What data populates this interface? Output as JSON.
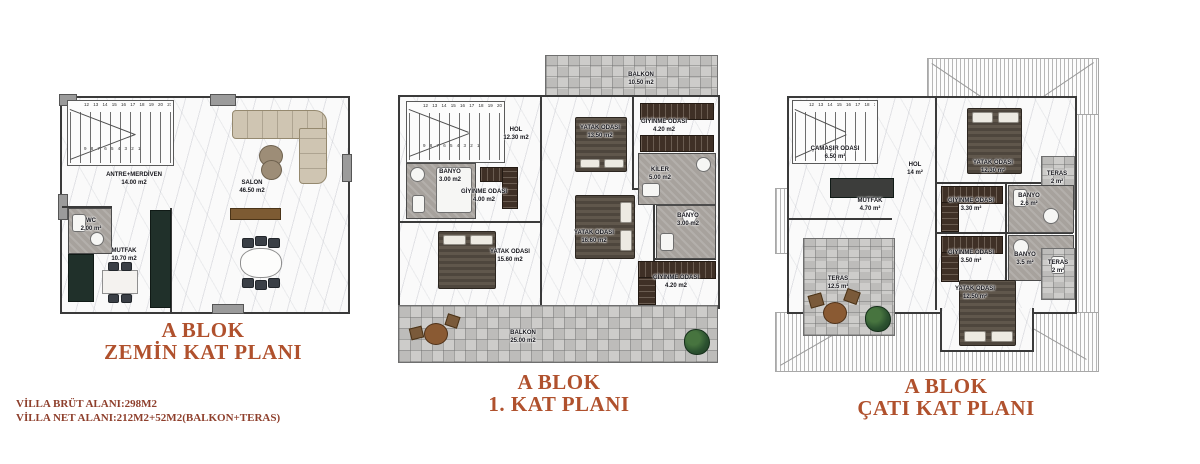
{
  "plans": [
    {
      "id": "zemin-kat",
      "title_line1": "A BLOK",
      "title_line2": "ZEMİN KAT PLANI",
      "stair_numbers_top": "12 13 14 15 16 17 18 19 20 21 22 23 24",
      "stair_numbers_run": "9 8 7 6 5 4 3 2 1",
      "rooms": {
        "antre": {
          "name": "ANTRE+MERDİVEN",
          "area": "14.00 m2"
        },
        "salon": {
          "name": "SALON",
          "area": "46.50 m2"
        },
        "wc": {
          "name": "WC",
          "area": "2.00 m²"
        },
        "mutfak": {
          "name": "MUTFAK",
          "area": "10.70 m2"
        }
      }
    },
    {
      "id": "kat-1",
      "title_line1": "A BLOK",
      "title_line2": "1. KAT PLANI",
      "stair_numbers_top": "12 13 14 15 16 17 18 19 20 21 22 23 24",
      "stair_numbers_run": "9 8 7 6 5 4 3 2 1",
      "rooms": {
        "balkon_ust": {
          "name": "BALKON",
          "area": "10.50 m2"
        },
        "hol": {
          "name": "HOL",
          "area": "12.30 m2"
        },
        "banyo_sol": {
          "name": "BANYO",
          "area": "3.00 m2"
        },
        "giyinme_sol": {
          "name": "GİYİNME ODASI",
          "area": "4.00 m2"
        },
        "yatak_ust": {
          "name": "YATAK ODASI",
          "area": "13.50 m2"
        },
        "giyinme_ustsag": {
          "name": "GİYİNME ODASI",
          "area": "4.20 m2"
        },
        "kiler": {
          "name": "KİLER",
          "area": "5.00 m2"
        },
        "banyo_sag": {
          "name": "BANYO",
          "area": "3.00 m2"
        },
        "yatak_sol": {
          "name": "YATAK ODASI",
          "area": "15.60 m2"
        },
        "yatak_orta": {
          "name": "YATAK ODASI",
          "area": "16.60 m2"
        },
        "giyinme_altsag": {
          "name": "GİYİNME ODASI",
          "area": "4.20 m2"
        },
        "balkon_alt": {
          "name": "BALKON",
          "area": "25.00 m2"
        }
      }
    },
    {
      "id": "cati-kat",
      "title_line1": "A BLOK",
      "title_line2": "ÇATI KAT PLANI",
      "stair_numbers_top": "12 13 14 15 16 17 18 19 20",
      "rooms": {
        "camasir": {
          "name": "ÇAMAŞIR ODASI",
          "area": "6.50 m²"
        },
        "hol": {
          "name": "HOL",
          "area": "14 m²"
        },
        "mutfak": {
          "name": "MUTFAK",
          "area": "4.70 m²"
        },
        "yatak_ust": {
          "name": "YATAK ODASI",
          "area": "12.30 m²"
        },
        "teras_ustsag": {
          "name": "TERAS",
          "area": "2 m²"
        },
        "giyinme_ust": {
          "name": "GİYİNME ODASI",
          "area": "3.30 m²"
        },
        "banyo_ust": {
          "name": "BANYO",
          "area": "2.6 m²"
        },
        "giyinme_alt": {
          "name": "GİYİNME ODASI",
          "area": "3.50 m²"
        },
        "banyo_alt": {
          "name": "BANYO",
          "area": "3.5 m²"
        },
        "yatak_alt": {
          "name": "YATAK ODASI",
          "area": "12.50 m²"
        },
        "teras_sol": {
          "name": "TERAS",
          "area": "12.5 m²"
        },
        "teras_altsag": {
          "name": "TERAS",
          "area": "2 m²"
        }
      }
    }
  ],
  "footer": {
    "line1": "VİLLA BRÜT ALANI:298M2",
    "line2": "VİLLA NET ALANI:212M2+52M2(BALKON+TERAS)"
  },
  "colors": {
    "title": "#b0512d",
    "footer": "#8e3f2c",
    "wall": "#3a3a3a",
    "balcony_tile": "#c6c5c3",
    "wardrobe_wood": "#3f3026",
    "sofa_beige": "#cfc5b2",
    "kitchen_counter": "#20302a"
  }
}
